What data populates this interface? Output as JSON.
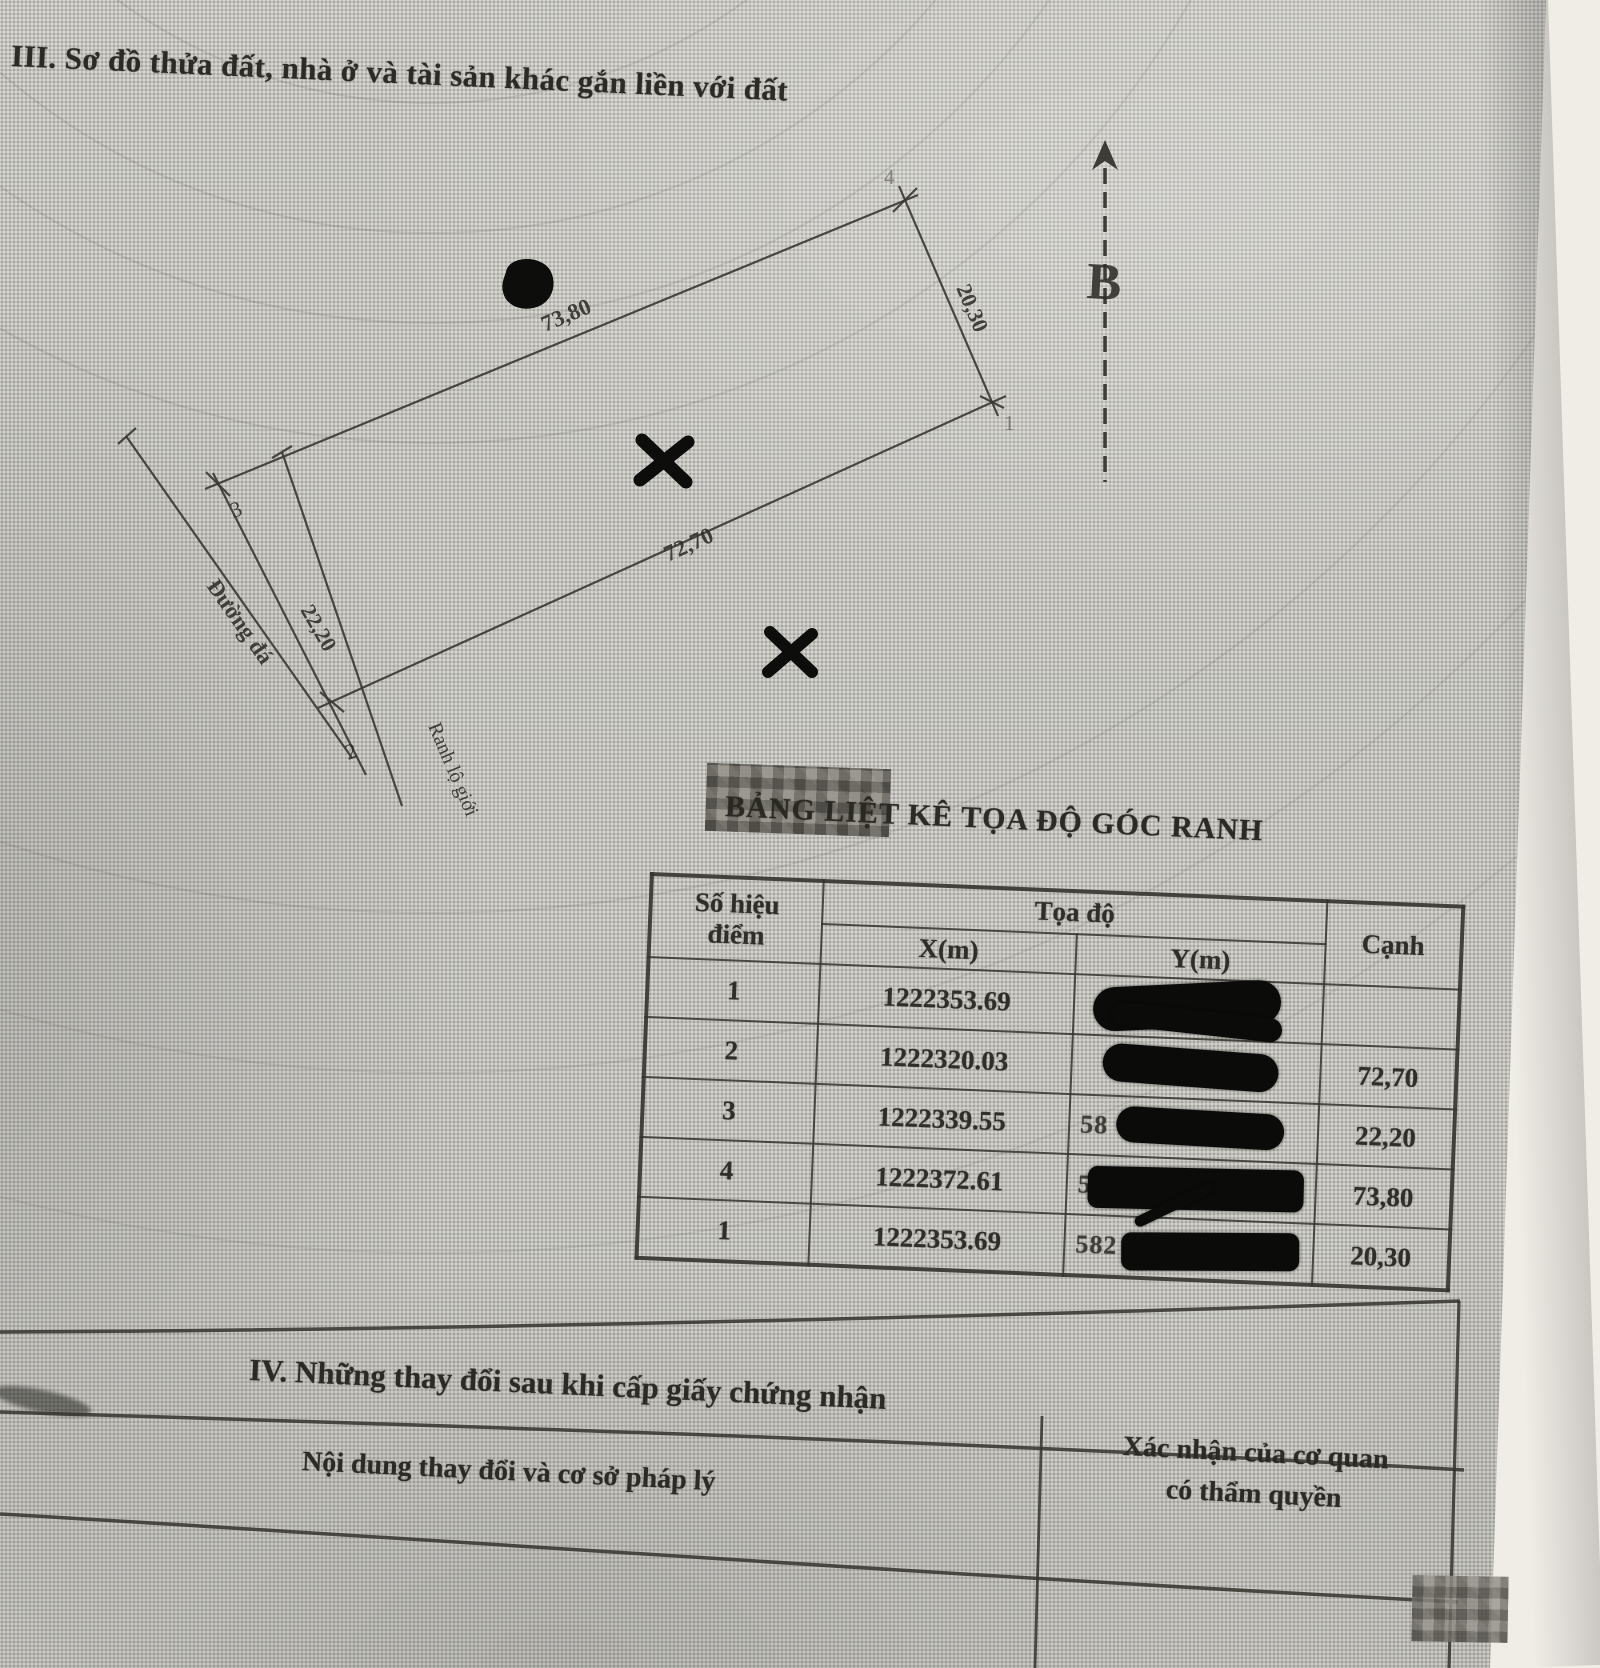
{
  "document": {
    "section3_heading": "III. Sơ đồ thửa đất, nhà ở và tài sản khác gắn liền với đất",
    "section4_heading": "IV. Những thay đổi sau khi cấp giấy chứng nhận"
  },
  "diagram": {
    "north_label": "B",
    "road_label": "Đường đá",
    "road_boundary_label": "Ranh lộ giới",
    "edge_top": "73,80",
    "edge_bottom": "72,70",
    "edge_left": "22,20",
    "edge_right": "20,30",
    "point_1": "1",
    "point_2": "2",
    "point_3": "3",
    "point_4": "4"
  },
  "coordinate_table": {
    "title": "BẢNG LIỆT KÊ TỌA ĐỘ GÓC RANH",
    "headers": {
      "point_line1": "Số hiệu",
      "point_line2": "điểm",
      "coords": "Tọa độ",
      "x": "X(m)",
      "y": "Y(m)",
      "edge": "Cạnh"
    },
    "rows": [
      {
        "point": "1",
        "x": "1222353.69",
        "y_visible": "",
        "edge": ""
      },
      {
        "point": "2",
        "x": "1222320.03",
        "y_visible": "",
        "edge": "72,70"
      },
      {
        "point": "3",
        "x": "1222339.55",
        "y_visible": "58",
        "edge": "22,20"
      },
      {
        "point": "4",
        "x": "1222372.61",
        "y_visible": "5",
        "edge": "73,80"
      },
      {
        "point": "1",
        "x": "1222353.69",
        "y_visible": "582",
        "edge": "20,30"
      }
    ]
  },
  "changes_table": {
    "col_content": "Nội dung thay đổi và cơ sở pháp lý",
    "col_confirm_line1": "Xác nhận của cơ quan",
    "col_confirm_line2": "có thẩm quyền"
  }
}
